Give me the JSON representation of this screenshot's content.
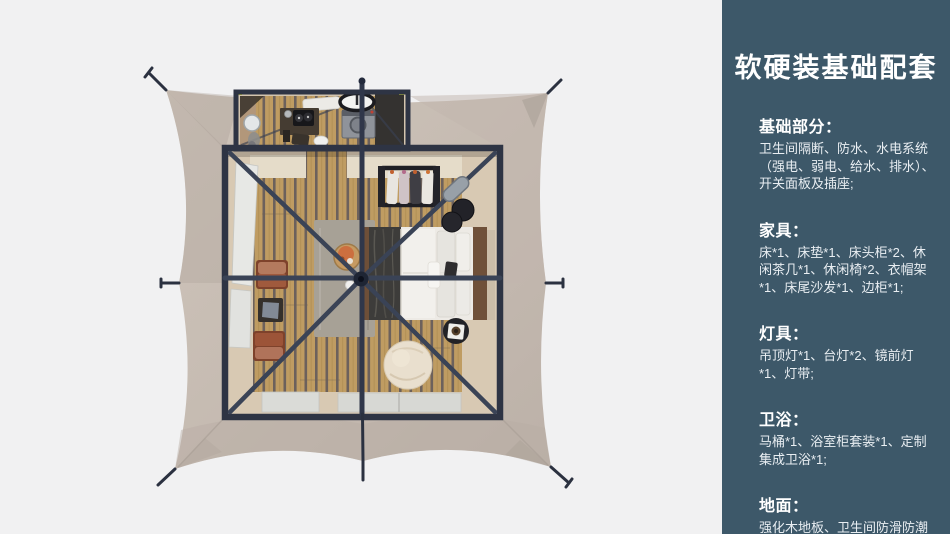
{
  "theme": {
    "page_bg": "#f1f1f2",
    "sidebar_bg": "#3d5869",
    "sidebar_text": "#ffffff",
    "sidebar_body_text": "#e9eef2",
    "canvas_light": "#cfc5bb",
    "canvas_dark": "#bcb1a8",
    "frame": "#2e3444",
    "beam": "#3a4356",
    "wood": "#bf9c62",
    "wood_seam": "#57525a",
    "floor_beige": "#d8c9b3",
    "cream_band": "#e5dcc9",
    "rug": "#a7a196",
    "terracotta": "#a05a3d",
    "terracotta_light": "#b47a5e",
    "pouf": "#e9dfce",
    "bed_white": "#edeae5"
  },
  "sidebar": {
    "title": "软硬装基础配套",
    "sections": [
      {
        "header": "基础部分：",
        "body": "卫生间隔断、防水、水电系统（强电、弱电、给水、排水）、开关面板及插座;"
      },
      {
        "header": "家具：",
        "body": "床*1、床垫*1、床头柜*2、休闲茶几*1、休闲椅*2、衣帽架*1、床尾沙发*1、边柜*1;"
      },
      {
        "header": "灯具：",
        "body": "吊顶灯*1、台灯*2、镜前灯*1、灯带;"
      },
      {
        "header": "卫浴：",
        "body": "马桶*1、浴室柜套装*1、定制集成卫浴*1;"
      },
      {
        "header": "地面：",
        "body": "强化木地板、卫生间防滑防潮石塑板;"
      }
    ]
  },
  "floorplan": {
    "view": "top-down 3d render of a framed safari tent guest room with stretched canvas roof",
    "rooms": [
      {
        "name": "bathroom",
        "items": [
          "round-mirror",
          "vanity-desk",
          "coffee-machine",
          "toilet",
          "washing-machine",
          "oval-sink",
          "ceiling-light-panel"
        ]
      },
      {
        "name": "bedroom",
        "items": [
          "double-bed",
          "pillows",
          "dark-throw-blanket",
          "clothes-rack-with-garments",
          "nightstand-stools",
          "tray-stool",
          "pouf",
          "rug",
          "round-side-table",
          "lounge-chair",
          "lounge-chair",
          "tea-table",
          "window-panels"
        ]
      }
    ],
    "structure": [
      "canvas-tarp",
      "guy-lines",
      "steel-frame",
      "center-pole",
      "radial-roof-beams"
    ]
  }
}
